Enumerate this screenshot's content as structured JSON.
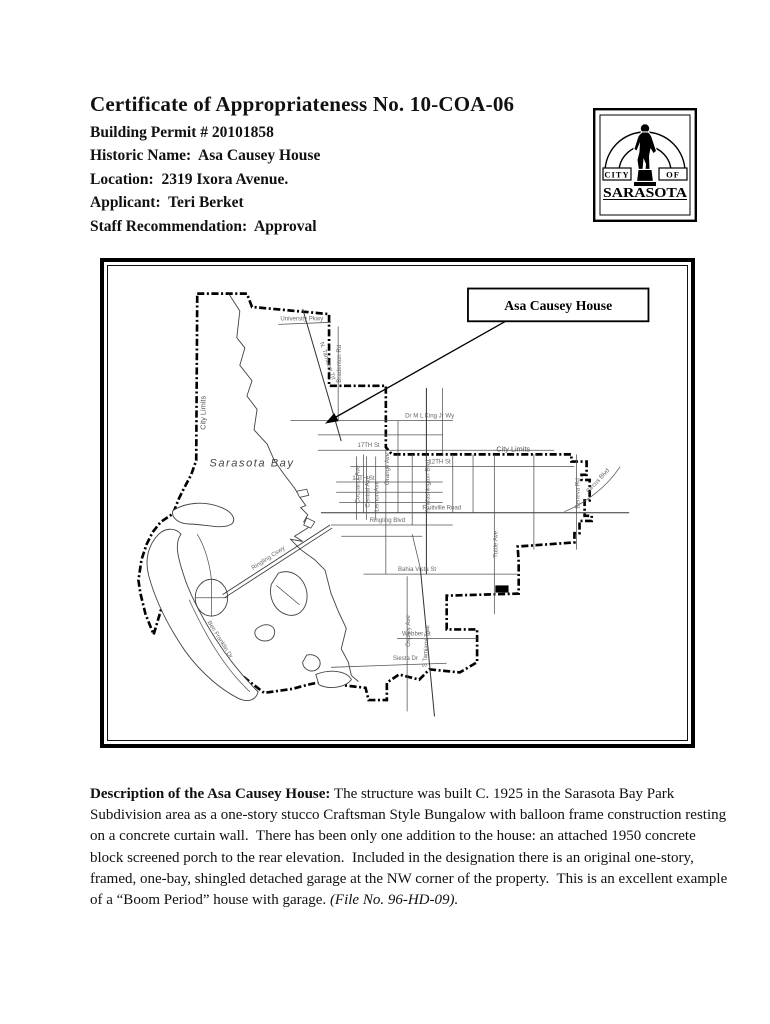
{
  "header": {
    "title": "Certificate of Appropriateness No. 10-COA-06",
    "lines": [
      "Building Permit # 20101858",
      "Historic Name:  Asa Causey House",
      "Location:  2319 Ixora Avenue.",
      "Applicant:  Teri Berket",
      "Staff Recommendation:  Approval"
    ]
  },
  "logo": {
    "city": "CITY",
    "of": "OF",
    "name": "SARASOTA"
  },
  "map": {
    "callout": "Asa Causey House",
    "labels": {
      "sarasota_bay": "Sarasota  Bay",
      "city_limits_left": "City Limits",
      "city_limits_top": "City Limits",
      "university_pkwy": "University Pkwy",
      "bradenton_rd": "Bradenton Rd",
      "n_tamiami_trl": "N. Tamiami Trl",
      "dr_mlk": "Dr M L King Jr Wy",
      "st_17th": "17TH  St",
      "st_12th": "12TH  St",
      "st_10th": "10TH  St",
      "fruitville": "Fruitville  Road",
      "ringling_blvd": "Ringling Blvd",
      "bahia_vista": "Bahia Vista St",
      "webber": "Webber St",
      "siesta": "Siesta Dr",
      "cocoanut": "Cocoanut Ave",
      "central": "Central Ave",
      "lemon": "Lemon Ave",
      "orange": "Orange Ave",
      "washington": "N Washington Blvd",
      "tuttle": "Tuttle Ave",
      "beneva": "Beneva Rd",
      "circus": "Circus Blvd",
      "osprey": "Osprey Ave",
      "s_tamiami": "S Tamiami Trail",
      "ringling_cswy": "Ringling Cswy",
      "ben_franklin": "Ben Franklin Dr"
    }
  },
  "description": {
    "lead": "Description of the Asa Causey House:",
    "body": " The structure was built C. 1925 in the Sarasota Bay Park Subdivision area as a one-story stucco Craftsman Style Bungalow with balloon frame construction resting on a concrete curtain wall.  There has been only one addition to the house: an attached 1950 concrete block screened porch to the rear elevation.  Included in the designation there is an original one-story, framed, one-bay, shingled detached garage at the NW corner of the property.  This is an excellent example of a “Boom Period” house with garage. ",
    "file_note": "(File No. 96-HD-09)."
  }
}
